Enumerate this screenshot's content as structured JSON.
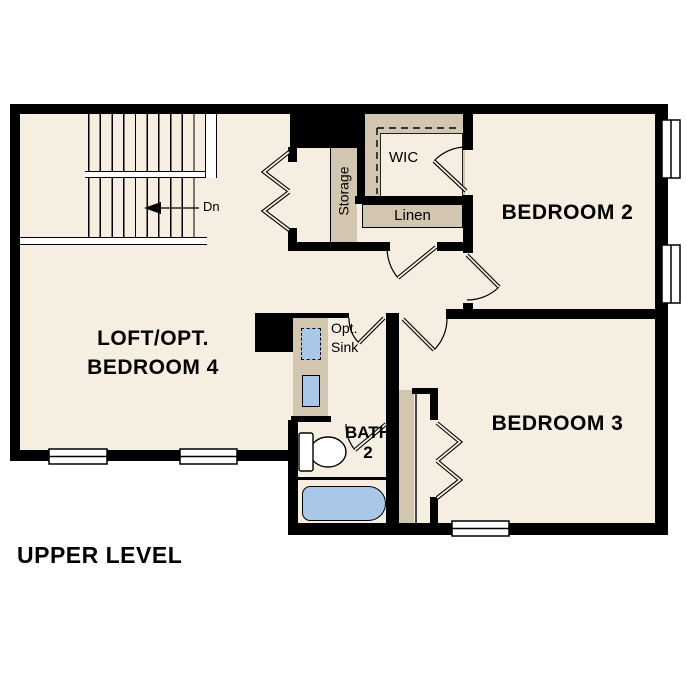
{
  "plan": {
    "title": "UPPER LEVEL",
    "rooms": {
      "loft": {
        "line1": "LOFT/OPT.",
        "line2": "BEDROOM 4"
      },
      "bedroom2": {
        "label": "BEDROOM 2"
      },
      "bedroom3": {
        "label": "BEDROOM 3"
      },
      "bath": {
        "line1": "BATH",
        "line2": "2"
      },
      "wic": {
        "label": "WIC"
      },
      "linen": {
        "label": "Linen"
      },
      "storage": {
        "label": "Storage"
      },
      "opt_sink": {
        "line1": "Opt.",
        "line2": "Sink"
      }
    },
    "stairs": {
      "direction_label": "Dn"
    },
    "colors": {
      "floor": "#f5eee1",
      "feature_tan": "#d2c6b0",
      "fixture_blue": "#a9c8e8",
      "wall": "#000000"
    }
  }
}
